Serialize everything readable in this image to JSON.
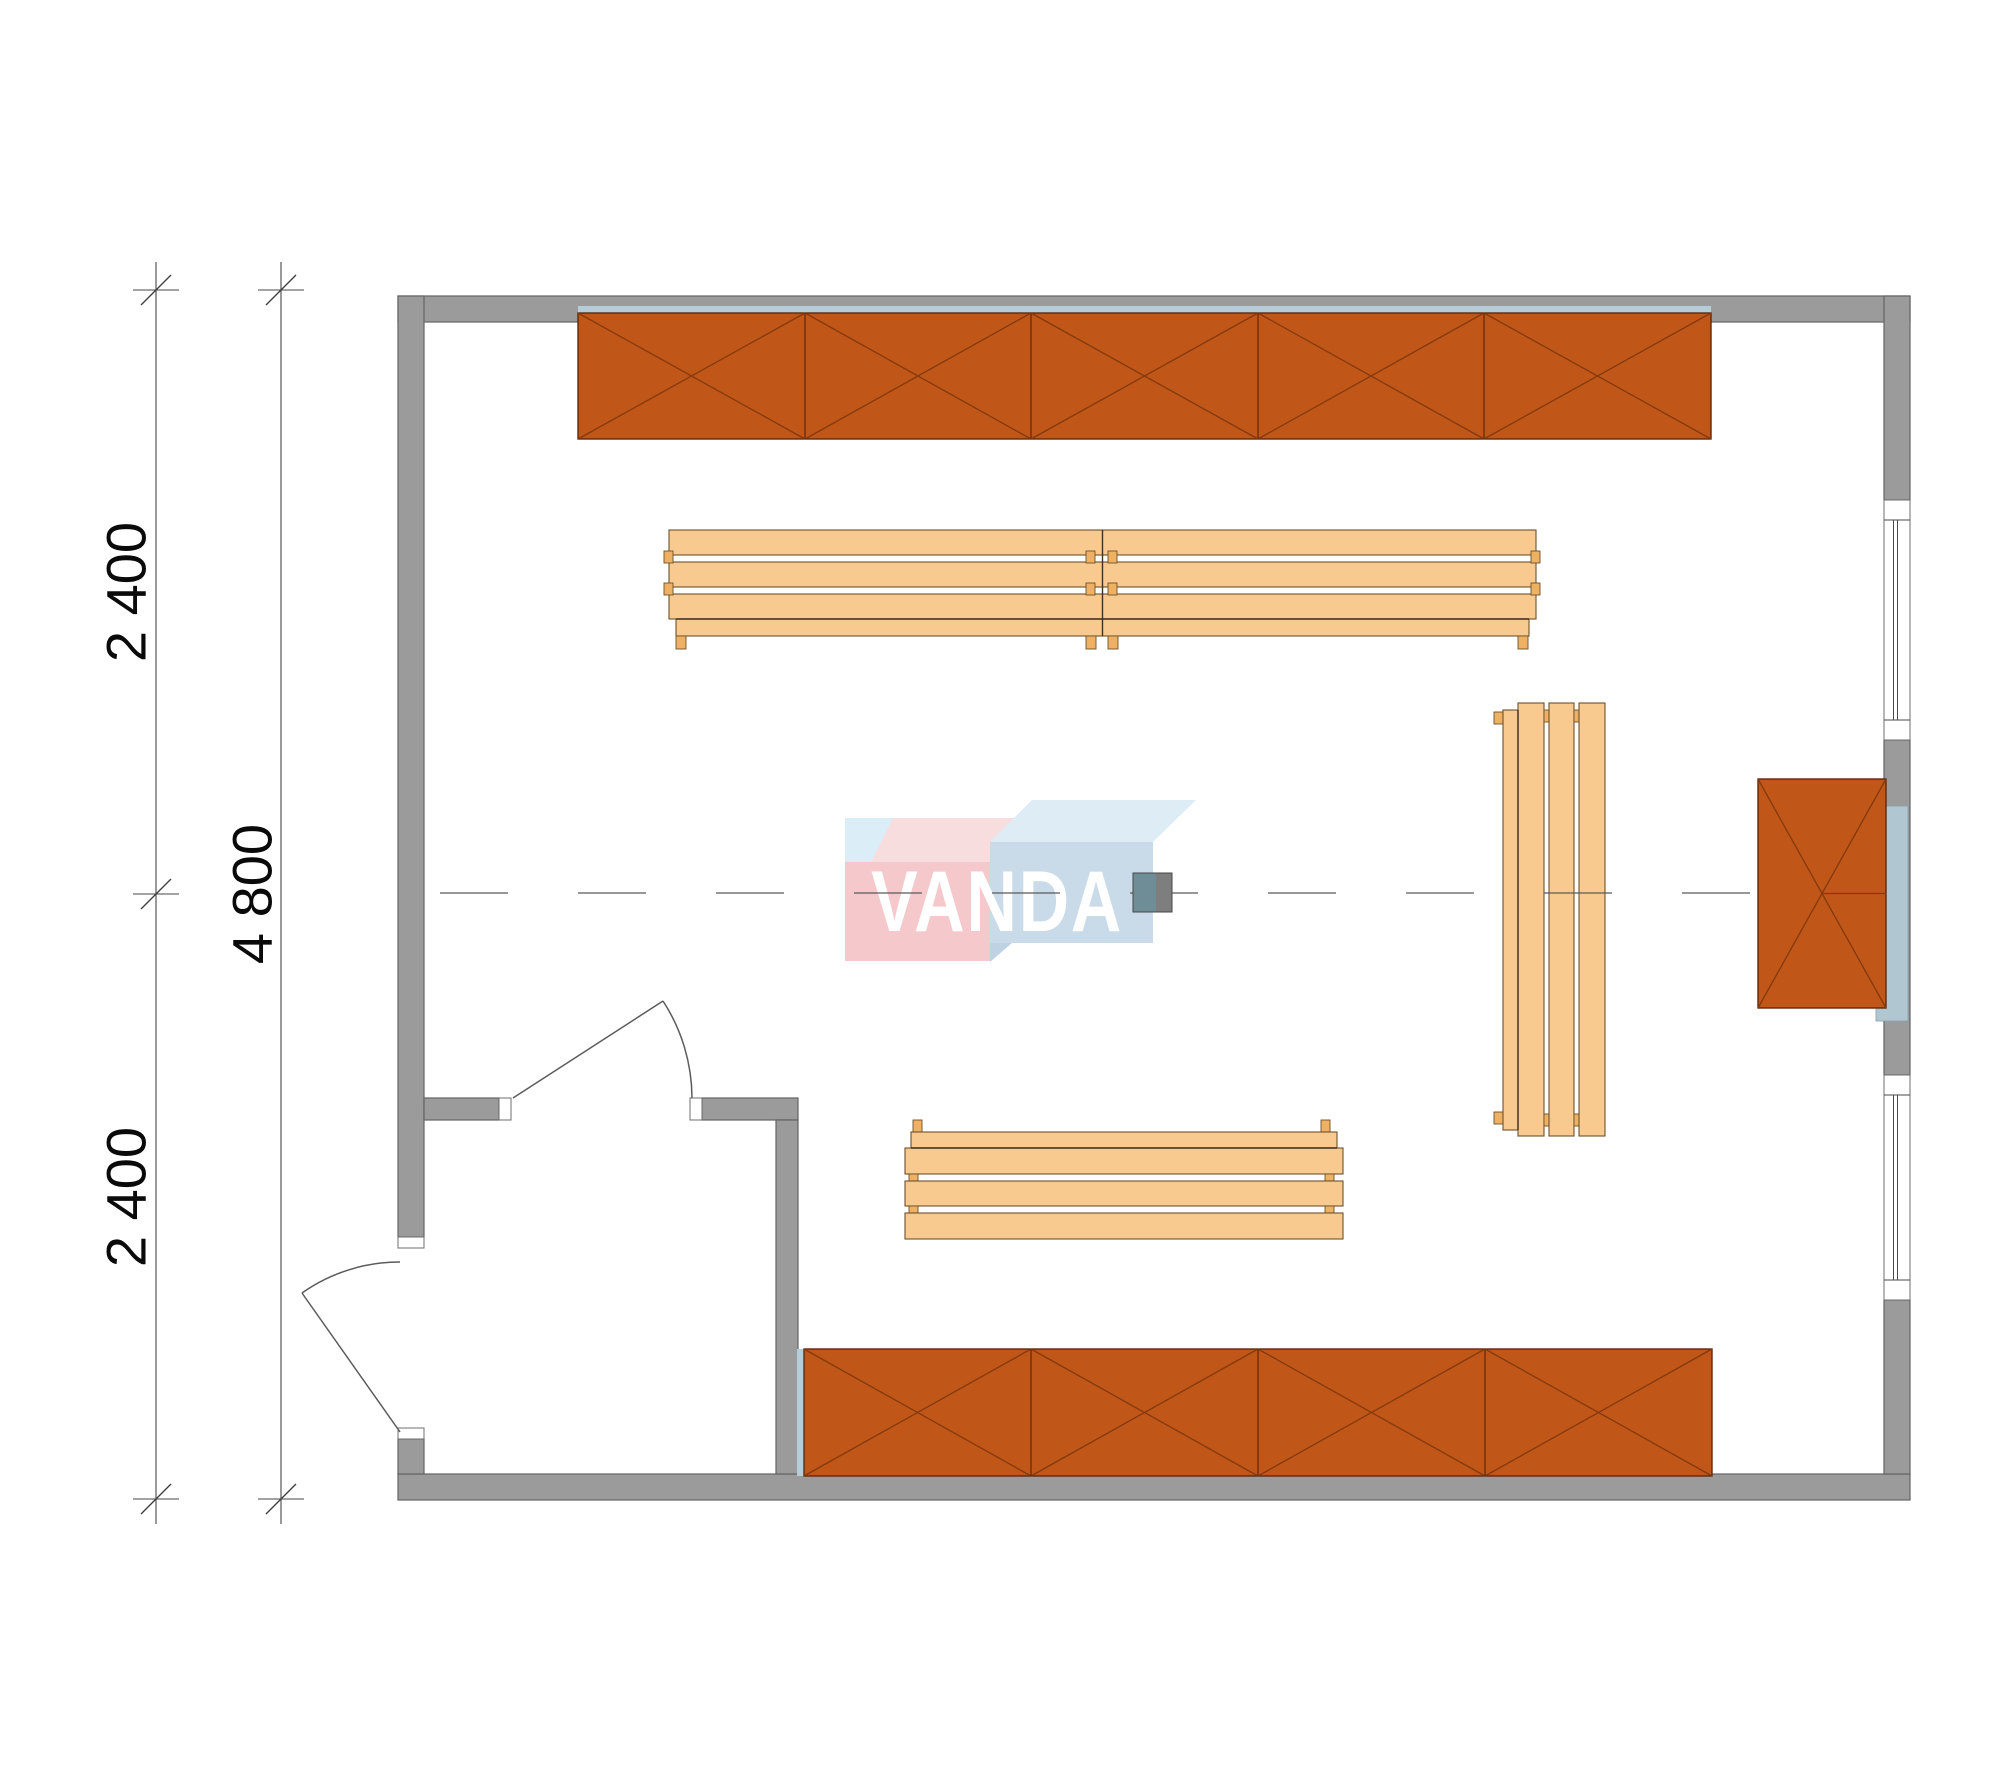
{
  "drawing": {
    "watermark": {
      "text": "VANDA"
    },
    "dimension_labels": {
      "left_segment_top": "2 400",
      "left_total": "4 800",
      "left_segment_bottom": "2 400"
    },
    "colors": {
      "background": "#ffffff",
      "wall_gray": "#9b9b9b",
      "shelf_orange": "#c05617",
      "bench_wood": "#f8ca90",
      "accent_blue": "#b5cdd9",
      "heater_shield_blue": "#b0c7d2",
      "logo_pink": "#f5c4c7",
      "logo_light_blue": "#c5d7e8",
      "marker_teal": "#6f8d96",
      "marker_gray": "#7e7e7e",
      "dimension_line": "#474747"
    },
    "element_counts": {
      "top_shelf_panels": 5,
      "bottom_shelf_panels": 4,
      "benches": 3,
      "windows": 2,
      "doors": 2,
      "heaters": 1
    }
  }
}
